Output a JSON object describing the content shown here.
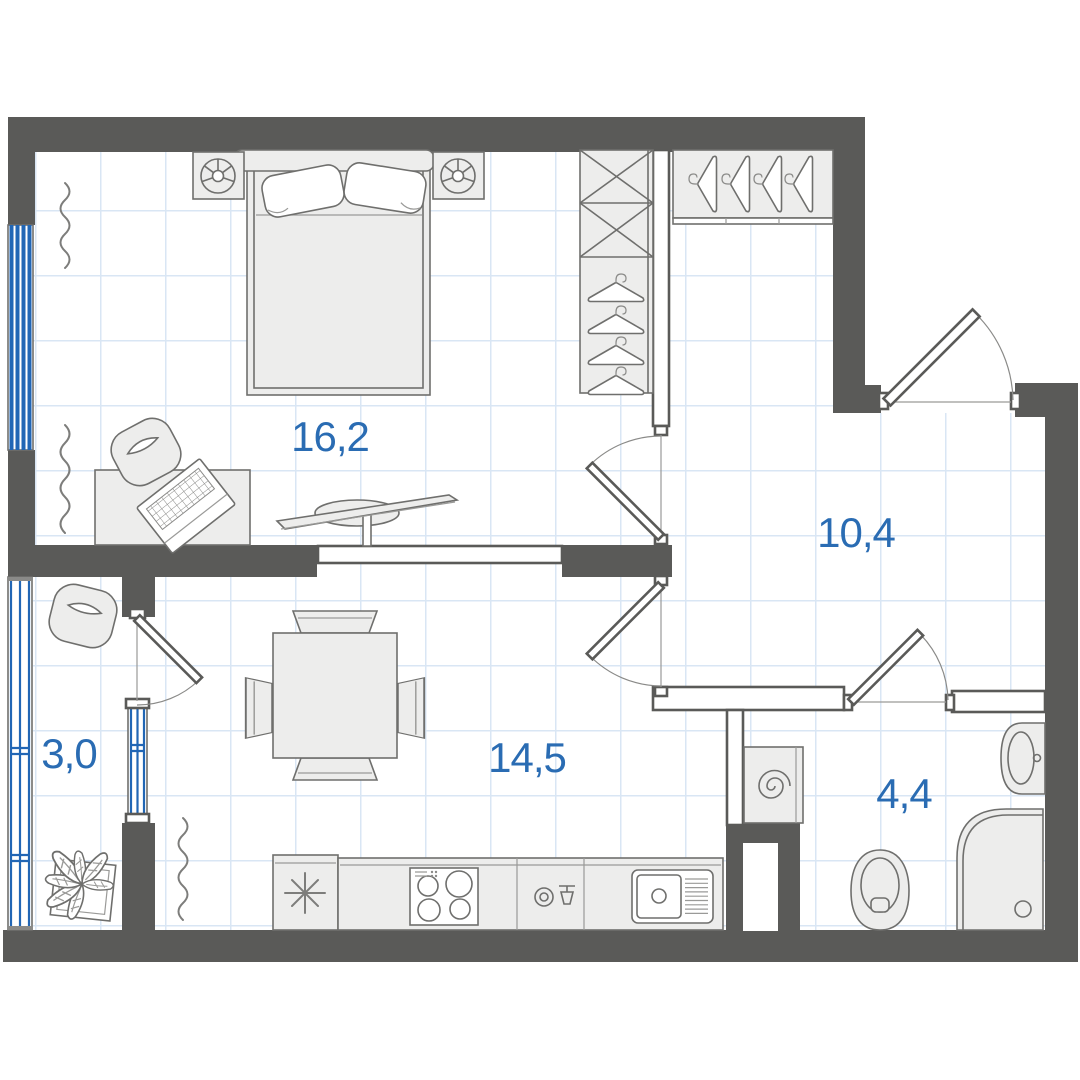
{
  "plan": {
    "type": "apartment-floor-plan",
    "rooms": [
      {
        "id": "bedroom",
        "area_label": "16,2"
      },
      {
        "id": "hallway",
        "area_label": "10,4"
      },
      {
        "id": "balcony",
        "area_label": "3,0"
      },
      {
        "id": "kitchen-living-room",
        "area_label": "14,5"
      },
      {
        "id": "bathroom",
        "area_label": "4,4"
      }
    ],
    "colors": {
      "wall": "#5a5a58",
      "outline": "#6f6f6d",
      "furn": "#ededec",
      "grid": "#d9e6f4",
      "blue": "#2166b5",
      "label": "#2a6cb3"
    },
    "symbols": [
      "bed",
      "nightstand-lamp",
      "wardrobe-shelves",
      "wardrobe-hangers",
      "closet-hangers",
      "desk",
      "laptop",
      "desk-chair",
      "tv",
      "armchair",
      "dining-table",
      "dining-chair",
      "radiator",
      "fridge",
      "stove",
      "dishwasher",
      "kitchen-sink",
      "plant",
      "washing-machine",
      "toilet",
      "washbasin",
      "shower",
      "window",
      "balcony-glazing",
      "door-swing"
    ]
  }
}
